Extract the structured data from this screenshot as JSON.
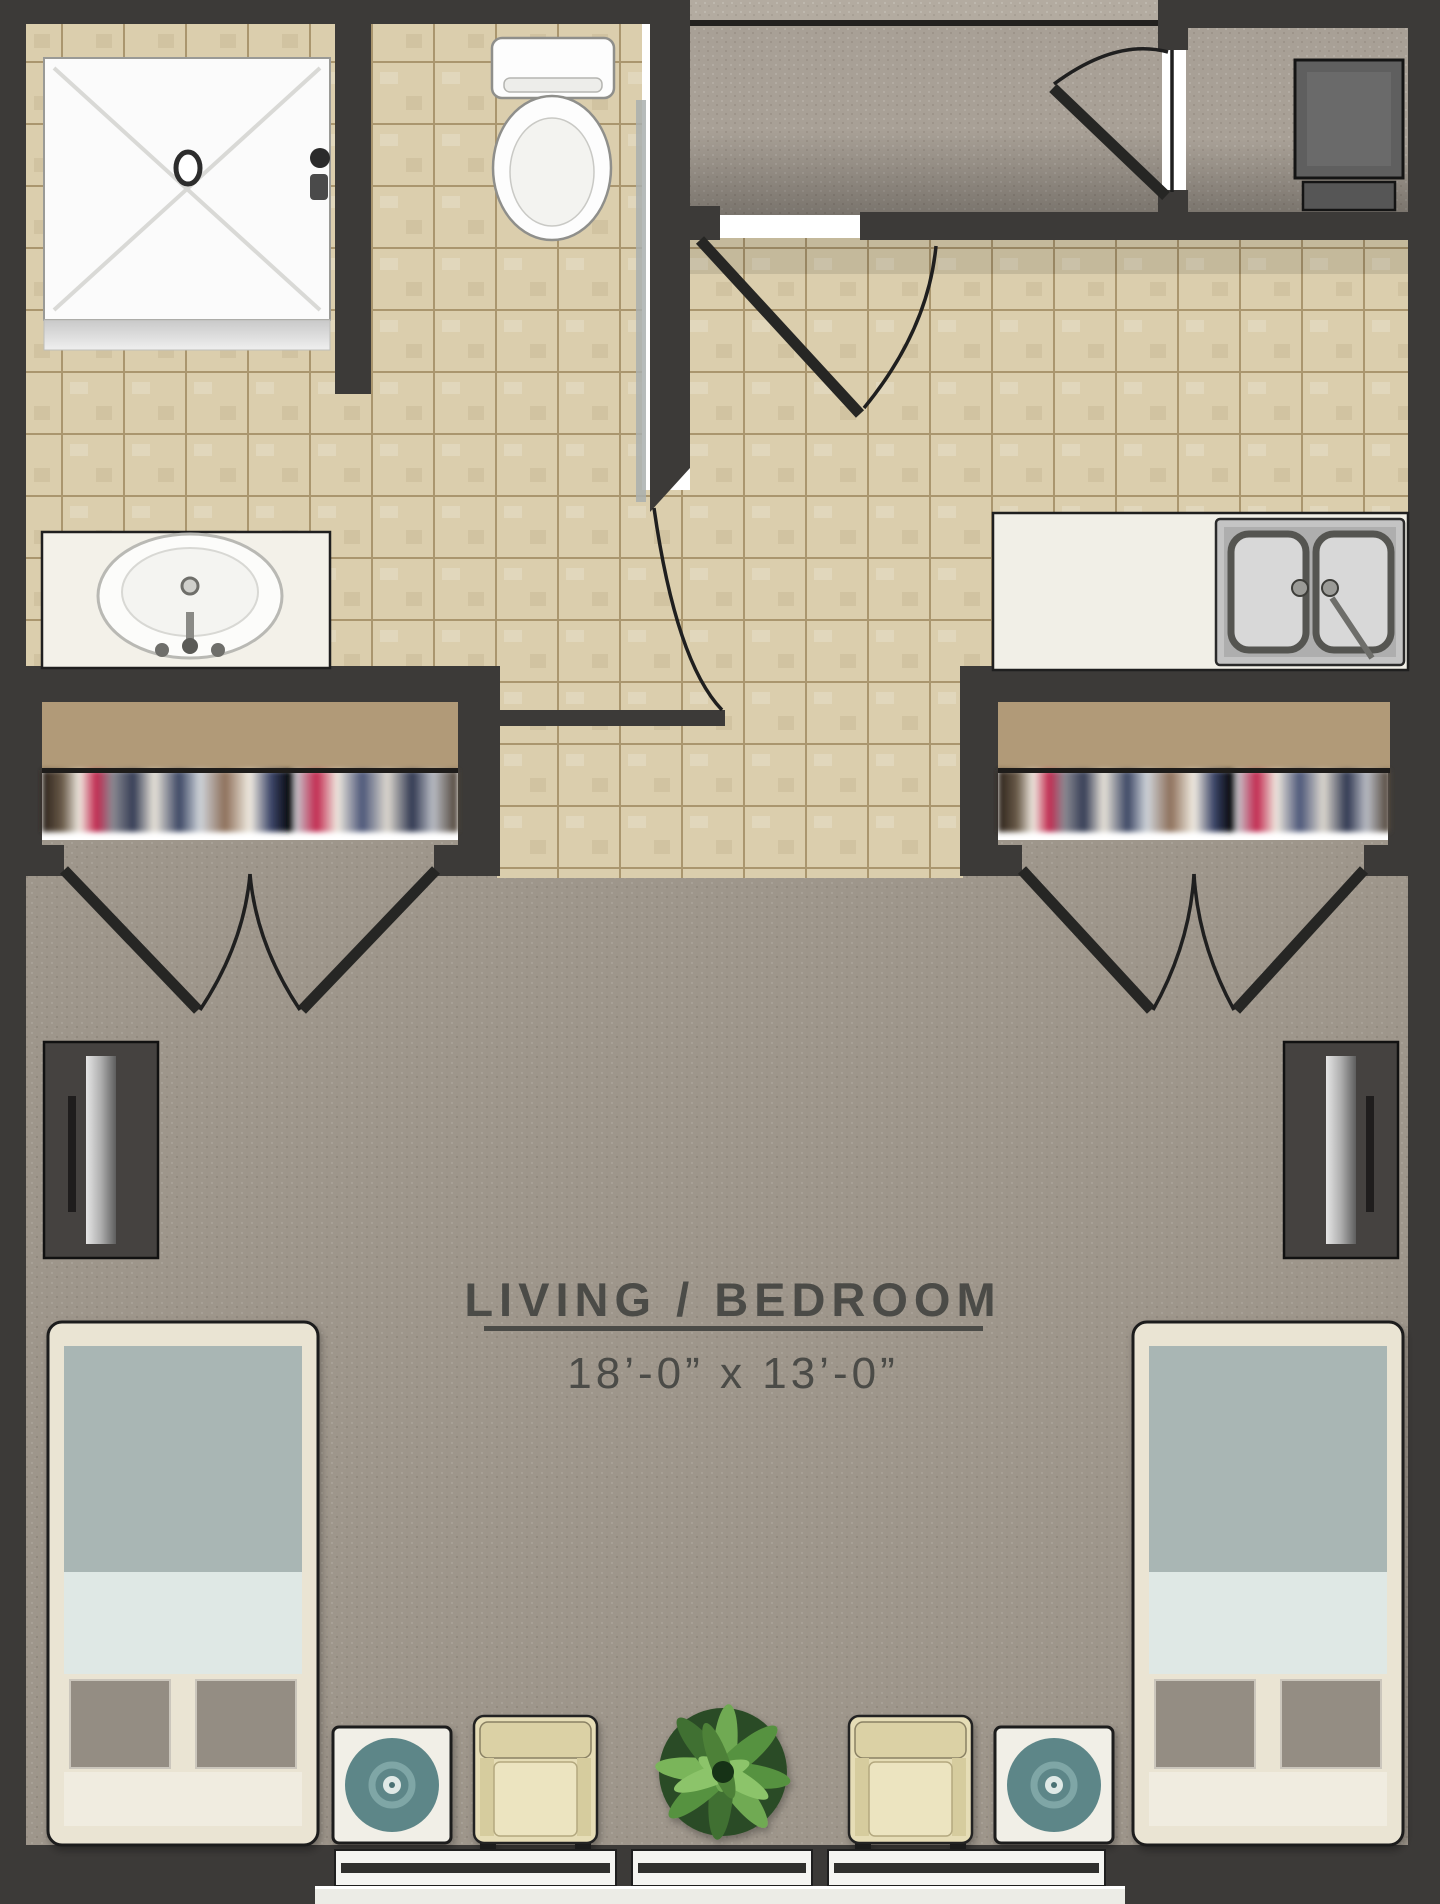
{
  "room": {
    "label": "LIVING / BEDROOM",
    "dimensions": "18’-0” x 13’-0”"
  },
  "areas": {
    "bathroom": "bathroom with shower, toilet and vanity sink",
    "entry": "entry corridor with swing door",
    "kitchen": "kitchenette counter with double sink",
    "closets": "two wardrobe closets with shelf and hanging clothes",
    "living": "shared living / bedroom with two beds, two armchairs, plant and side tables"
  },
  "palette": {
    "wall": "#3c3a38",
    "tile": "#dbcead",
    "grout": "#8a7a56",
    "carpet": "#9e968b",
    "hall_carpet": "#a8a096",
    "outside_carpet": "#b3aba0",
    "closet_shelf": "#b19a78",
    "accent_teal": "#5d8688",
    "bed_blanket": "#a9b6b4",
    "bed_sheet": "#dfe8e5",
    "bed_frame": "#eae4d3",
    "bed_pad": "#948d83",
    "chair": "#e6ddb6",
    "plant": "#4e8138",
    "counter": "#f1efe7",
    "appliance": "#5f5f5f",
    "label_text": "#4b4b47"
  }
}
